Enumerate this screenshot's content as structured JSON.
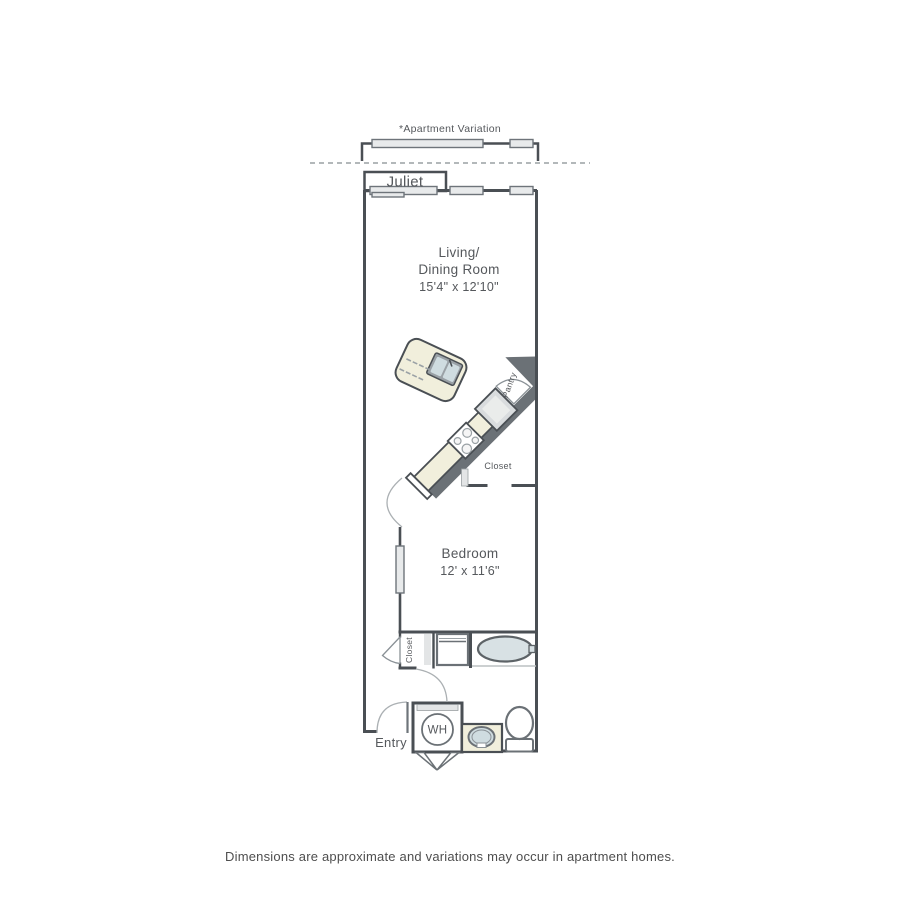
{
  "plan": {
    "variation_label": "*Apartment Variation",
    "juliet_label": "Juliet",
    "living_room": {
      "name_line1": "Living/",
      "name_line2": "Dining Room",
      "dimensions": "15'4\" x 12'10\""
    },
    "kitchen": {
      "pantry_label": "Pantry",
      "closet_label": "Closet"
    },
    "bedroom": {
      "name": "Bedroom",
      "dimensions": "12' x 11'6\""
    },
    "bathroom": {
      "hall_closet_label": "Closet",
      "water_heater_label": "WH"
    },
    "entry_label": "Entry"
  },
  "footer": {
    "disclaimer": "Dimensions are approximate and variations may occur in apartment homes."
  },
  "colors": {
    "wall_line": "#4a4f54",
    "wall_fill": "#6b7176",
    "counter_cream": "#f1efdc",
    "fixture_blue": "#cfdce0",
    "window_gray": "#e8eaeb"
  }
}
